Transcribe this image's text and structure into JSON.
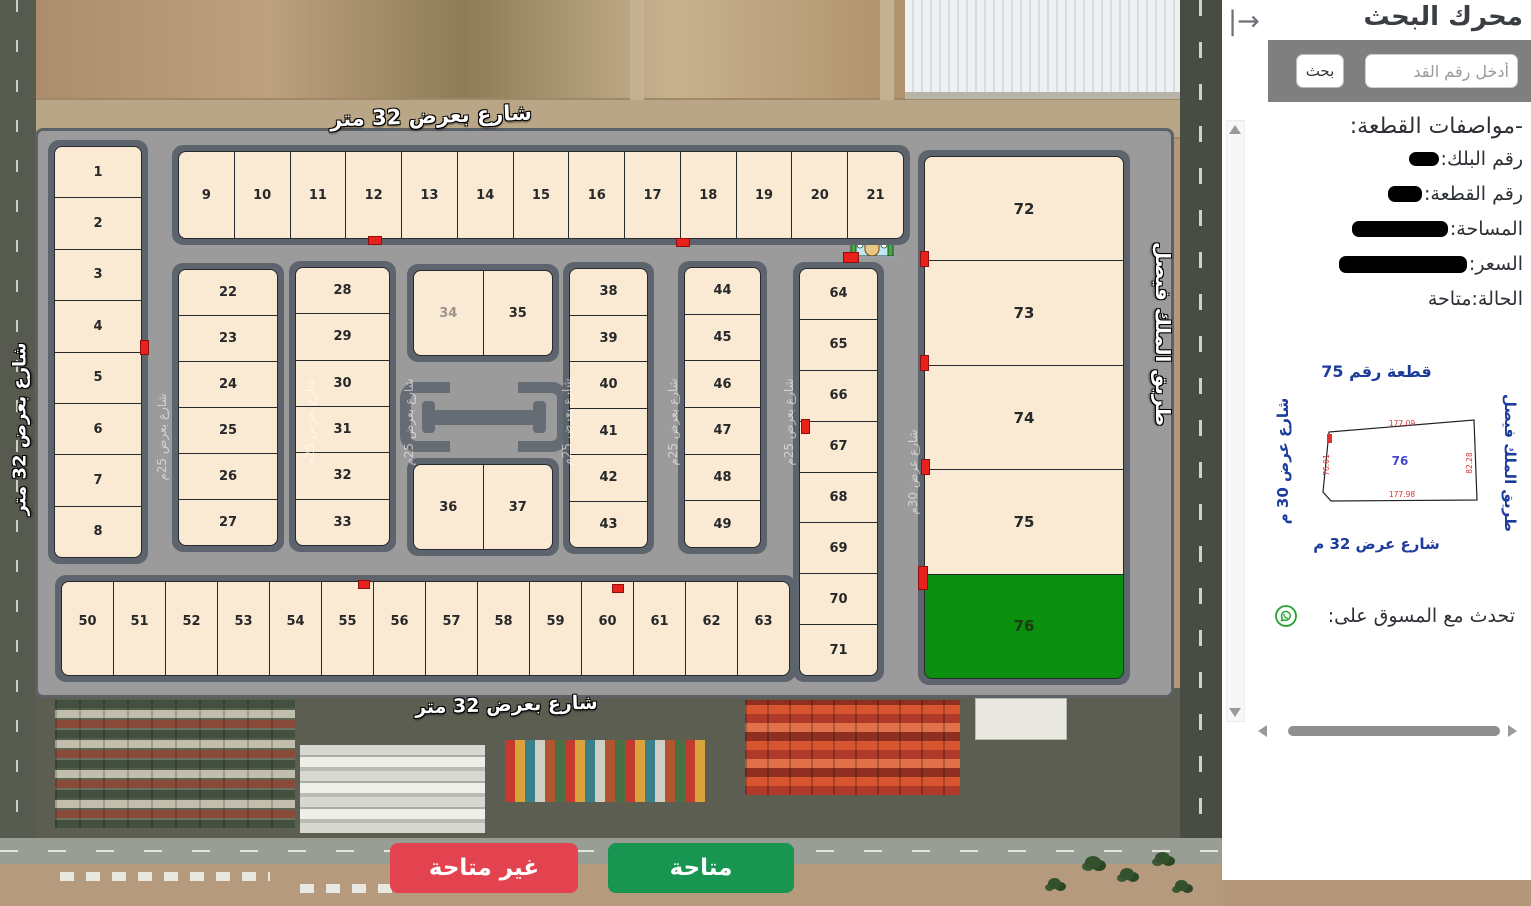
{
  "sidebar": {
    "collapse_icon": "|→",
    "search_title": "محرك البحث",
    "search_placeholder": "أدخل رقم القد",
    "search_button": "بحث",
    "specs_title": "-مواصفات القطعة:",
    "spec_block_label": "رقم البلك:",
    "spec_plot_label": "رقم القطعة:",
    "spec_area_label": "المساحة:",
    "spec_price_label": "السعر:",
    "spec_status": "الحالة:متاحة",
    "diagram": {
      "title": "قطعة رقم 75",
      "street_left": "شارع عرض 30 م",
      "street_right": "طريق الملك فيصل",
      "street_bottom": "شارع عرض 32 م",
      "plot_number": "76",
      "dim_top": "177.09",
      "dim_bottom": "177.98",
      "dim_left": "76.01",
      "dim_right": "82.28"
    },
    "contact_label": "تحدث مع المسوق على:",
    "whatsapp_icon": "whatsapp-icon"
  },
  "map": {
    "street_top": "شارع بعرض 32 متر",
    "street_bottom": "شارع بعرض 32 متر",
    "street_left": "شارع بعرض 32 متر",
    "street_right": "طريق الملك فيصل",
    "inner_street_25": "شارع بعرض 25م",
    "inner_street_30": "شارع عرض 30م",
    "available_plot": "76",
    "dim_number_plot": "34",
    "colors": {
      "available_plot": "#0b8f0e",
      "plot": "#fbead3",
      "legend_available": "#179551",
      "legend_unavailable": "#e2434f"
    },
    "legend": {
      "unavailable": "غير متاحة",
      "available": "متاحة"
    },
    "icons": [
      "hospital-icon",
      "mosque-icon",
      "whatsapp-icon"
    ],
    "blocks": [
      {
        "name": "block-left",
        "dir": "column",
        "x": 48,
        "y": 140,
        "w": 100,
        "h": 424,
        "plots": [
          "1",
          "2",
          "3",
          "4",
          "5",
          "6",
          "7",
          "8"
        ]
      },
      {
        "name": "block-top-row",
        "dir": "row",
        "x": 172,
        "y": 145,
        "w": 738,
        "h": 100,
        "plots": [
          "9",
          "10",
          "11",
          "12",
          "13",
          "14",
          "15",
          "16",
          "17",
          "18",
          "19",
          "20",
          "21"
        ]
      },
      {
        "name": "block-22-27",
        "dir": "column",
        "x": 172,
        "y": 263,
        "w": 112,
        "h": 289,
        "plots": [
          "22",
          "23",
          "24",
          "25",
          "26",
          "27"
        ]
      },
      {
        "name": "block-28-33",
        "dir": "column",
        "x": 289,
        "y": 261,
        "w": 107,
        "h": 291,
        "plots": [
          "28",
          "29",
          "30",
          "31",
          "32",
          "33"
        ]
      },
      {
        "name": "block-34-35",
        "dir": "row",
        "x": 407,
        "y": 264,
        "w": 152,
        "h": 98,
        "plots": [
          "34",
          "35"
        ]
      },
      {
        "name": "block-36-37",
        "dir": "row",
        "x": 407,
        "y": 458,
        "w": 152,
        "h": 98,
        "plots": [
          "36",
          "37"
        ]
      },
      {
        "name": "block-38-43",
        "dir": "column",
        "x": 563,
        "y": 262,
        "w": 91,
        "h": 292,
        "plots": [
          "38",
          "39",
          "40",
          "41",
          "42",
          "43"
        ]
      },
      {
        "name": "block-44-49",
        "dir": "column",
        "x": 678,
        "y": 261,
        "w": 89,
        "h": 293,
        "plots": [
          "44",
          "45",
          "46",
          "47",
          "48",
          "49"
        ]
      },
      {
        "name": "block-64-71",
        "dir": "column",
        "x": 793,
        "y": 262,
        "w": 91,
        "h": 420,
        "plots": [
          "64",
          "65",
          "66",
          "67",
          "68",
          "69",
          "70",
          "71"
        ]
      },
      {
        "name": "block-bottom-row",
        "dir": "row",
        "x": 55,
        "y": 575,
        "w": 741,
        "h": 107,
        "plots": [
          "50",
          "51",
          "52",
          "53",
          "54",
          "55",
          "56",
          "57",
          "58",
          "59",
          "60",
          "61",
          "62",
          "63"
        ]
      },
      {
        "name": "block-right",
        "dir": "column",
        "x": 918,
        "y": 150,
        "w": 212,
        "h": 535,
        "plots": [
          "72",
          "73",
          "74",
          "75",
          "76"
        ]
      }
    ]
  }
}
